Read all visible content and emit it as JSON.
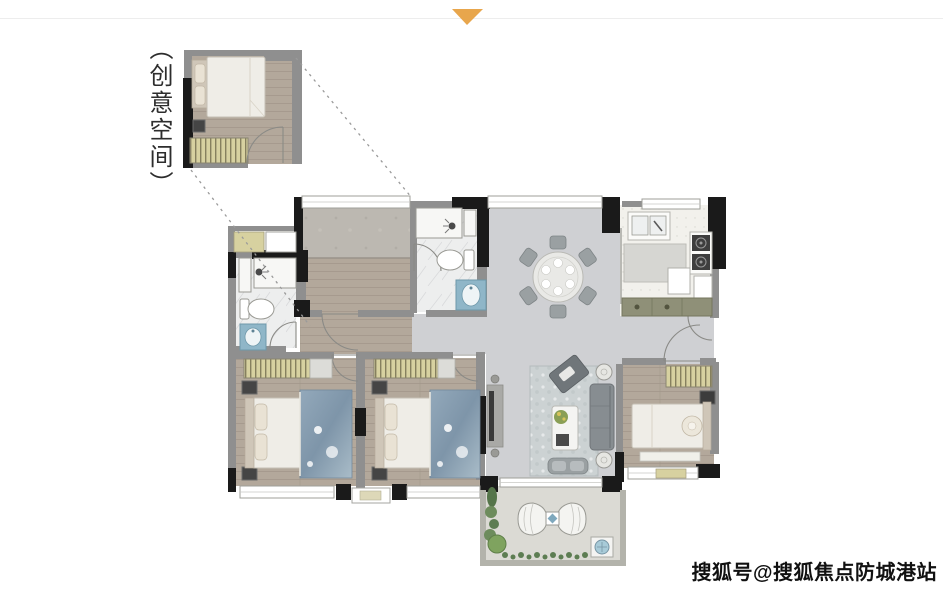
{
  "page": {
    "background": "#ffffff",
    "width": 943,
    "height": 590
  },
  "header": {
    "pointer_icon": "▼"
  },
  "inset": {
    "label": "（创意空间）"
  },
  "watermark": {
    "text": "搜狐号@搜狐焦点防城港站"
  },
  "palette": {
    "pointer_orange": "#E8A64C",
    "wall_black": "#1a1a1a",
    "wall_grey": "#8f8f8f",
    "balcony_wall": "#b3b3ab",
    "floor_public": "#cfd0d3",
    "floor_wood": "#b3a89b",
    "floor_bath": "#edeeee",
    "floor_kitchen": "#f2f1ec",
    "floor_balcony": "#dbdad4",
    "concrete_grey": "#bcb8b1",
    "bed_white": "#efede7",
    "headboard_beige": "#cfc6b8",
    "blanket_blue": "#8aa0b4",
    "wardrobe_khaki": "#d7d1a0",
    "fixture_blue": "#8fb6c8",
    "bar_olive": "#8f9078",
    "sofa_grey": "#878d91",
    "rug_grey": "#ccd2d3",
    "plant_green": "#6d8c5c",
    "chair_grey": "#9aa0a2"
  }
}
